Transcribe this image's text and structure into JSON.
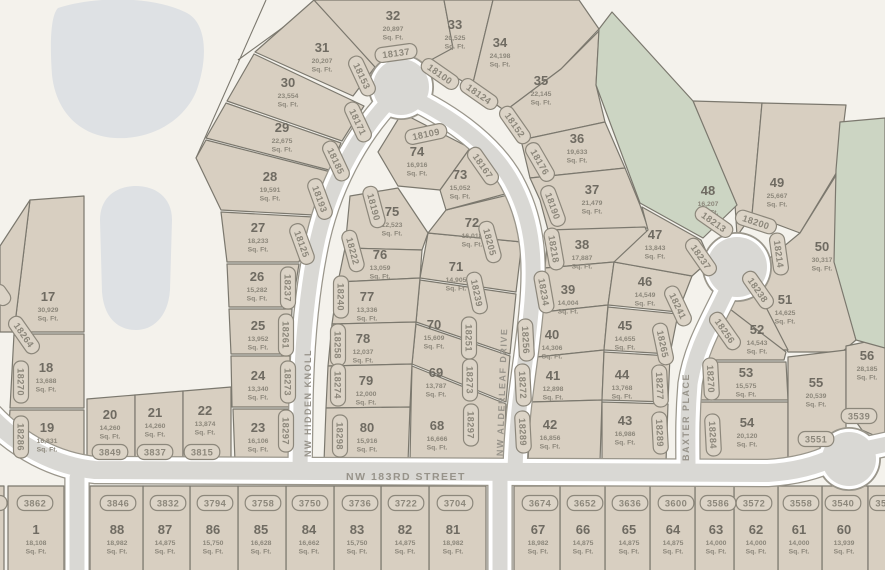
{
  "map": {
    "colors": {
      "background": "#f4f2ec",
      "lot_fill": "#d8cfc1",
      "green_fill": "#ccd5c3",
      "pond_fill": "#dee1e4",
      "street_fill": "#d9d8d4",
      "street_casing": "#ffffff",
      "street_halo": "#9a968b",
      "lot_stroke": "#7b786e",
      "number_color": "#6f6b62",
      "sqft_color": "#8c877b",
      "badge_color": "#8c877b",
      "badge_fill": "#dcd4c7",
      "street_label_color": "#97938a"
    },
    "sqft_suffix": "Sq. Ft.",
    "street_labels": [
      {
        "text": "NW HIDDEN KNOLL",
        "x": 311,
        "y": 403,
        "rot": -90,
        "size": 9
      },
      {
        "text": "NW ALDERLEAF DRIVE",
        "x": 505,
        "y": 392,
        "rot": -88,
        "size": 9
      },
      {
        "text": "BAXTER PLACE",
        "x": 689,
        "y": 417,
        "rot": -90,
        "size": 9
      },
      {
        "text": "NW 183RD STREET",
        "x": 406,
        "y": 480,
        "rot": 0,
        "size": 10.5
      }
    ],
    "street_paths": [
      {
        "name": "nw-hidden-knoll",
        "d": "M 400,90 C 362,126 332,178 318,238 C 306,292 302,350 301,400 L 300,470",
        "w": 15
      },
      {
        "name": "nw-alderleaf-drive",
        "d": "M 404,94 C 452,116 496,148 515,188 C 533,224 536,262 531,312 C 526,366 517,402 515,470",
        "w": 15
      },
      {
        "name": "baxter-place",
        "d": "M 737,266 C 722,308 697,338 690,384 C 687,420 688,444 688,470",
        "w": 15
      },
      {
        "name": "nw-183rd-street",
        "d": "M -10,416 C 18,446 55,466 95,470 L 768,473 C 800,471 820,464 834,457",
        "w": 18
      },
      {
        "name": "south-stub-west",
        "d": "M 77,478 L 77,578",
        "w": 15
      },
      {
        "name": "south-stub-east",
        "d": "M 500,478 L 500,578",
        "w": 15
      },
      {
        "name": "east-exit",
        "d": "M 860,450 L 892,443",
        "w": 15
      }
    ],
    "street_circles": [
      {
        "name": "teardrop-turnaround",
        "cx": 401,
        "cy": 87,
        "r": 28
      },
      {
        "name": "baxter-bulb",
        "cx": 737,
        "cy": 267,
        "r": 30
      },
      {
        "name": "knuckle-east",
        "cx": 849,
        "cy": 459,
        "r": 27
      }
    ],
    "ponds": [
      {
        "d": "M 58,8 C 95,-4 152,-4 185,12 C 208,22 208,60 196,92 C 183,122 150,140 115,138 C 80,136 56,112 52,75 C 50,48 50,16 58,8 Z"
      },
      {
        "d": "M 100,220 C 100,196 118,186 136,186 C 154,186 172,196 172,220 L 170,290 C 168,318 152,330 136,330 C 118,330 104,318 102,292 Z"
      }
    ],
    "extra_lines": [
      {
        "x1": 196,
        "y1": 158,
        "x2": 266,
        "y2": 0
      },
      {
        "x1": 318,
        "y1": 2,
        "x2": 238,
        "y2": 60
      }
    ],
    "greens": [
      {
        "poly": "612,12 693,101 737,205 703,238 640,203 596,85 599,29"
      },
      {
        "poly": "840,122 885,118 885,348 856,340 834,262 836,170"
      }
    ],
    "lots": [
      {
        "n": "1",
        "sq": "18,108",
        "addr": "3862",
        "poly": "8,486 64,486 64,575 8,575",
        "nx": 36,
        "ny": 530,
        "ax": 35,
        "ay": 503,
        "ar": 0
      },
      {
        "n": "",
        "sq": "",
        "addr": "",
        "poly": "-6,486 4,486 4,575 -6,575",
        "nx": 0,
        "ny": 0,
        "ax": -4,
        "ay": 503,
        "ar": 0
      },
      {
        "n": "17",
        "sq": "30,929",
        "addr": "18264",
        "poly": "30,200 84,196 84,332 14,332",
        "nx": 48,
        "ny": 297,
        "ax": 24,
        "ay": 335,
        "ar": 55
      },
      {
        "n": "",
        "sq": "",
        "addr": "",
        "poly": "30,200 14,332 0,332 0,246",
        "nx": 0,
        "ny": 0,
        "ax": 1,
        "ay": 295,
        "ar": 55
      },
      {
        "n": "18",
        "sq": "13,688",
        "addr": "18270",
        "poly": "14,334 84,334 84,408 10,408",
        "nx": 46,
        "ny": 368,
        "ax": 21,
        "ay": 382,
        "ar": 90
      },
      {
        "n": "19",
        "sq": "16,831",
        "addr": "18286",
        "poly": "10,410 84,410 84,462 36,462 8,440",
        "nx": 47,
        "ny": 428,
        "ax": 21,
        "ay": 437,
        "ar": 90
      },
      {
        "n": "20",
        "sq": "14,260",
        "addr": "3849",
        "poly": "87,399 135,395 135,462 87,462",
        "nx": 110,
        "ny": 415,
        "ax": 110,
        "ay": 452,
        "ar": 0
      },
      {
        "n": "21",
        "sq": "14,260",
        "addr": "3837",
        "poly": "135,395 183,391 183,462 135,462",
        "nx": 155,
        "ny": 413,
        "ax": 155,
        "ay": 452,
        "ar": 0
      },
      {
        "n": "22",
        "sq": "13,874",
        "addr": "3815",
        "poly": "183,391 231,387 231,462 183,462",
        "nx": 205,
        "ny": 411,
        "ax": 202,
        "ay": 452,
        "ar": 0
      },
      {
        "n": "23",
        "sq": "16,106",
        "addr": "18297",
        "poly": "233,409 289,409 289,462 235,462",
        "nx": 258,
        "ny": 428,
        "ax": 286,
        "ay": 431,
        "ar": 90
      },
      {
        "n": "24",
        "sq": "13,340",
        "addr": "18273",
        "poly": "231,356 290,356 289,407 232,407",
        "nx": 258,
        "ny": 376,
        "ax": 288,
        "ay": 382,
        "ar": 90
      },
      {
        "n": "25",
        "sq": "13,952",
        "addr": "18261",
        "poly": "229,309 292,309 290,354 231,354",
        "nx": 258,
        "ny": 326,
        "ax": 286,
        "ay": 335,
        "ar": 90
      },
      {
        "n": "26",
        "sq": "15,282",
        "addr": "18237",
        "poly": "227,264 299,264 292,307 229,307",
        "nx": 257,
        "ny": 277,
        "ax": 288,
        "ay": 288,
        "ar": 90
      },
      {
        "n": "27",
        "sq": "18,233",
        "addr": "18125",
        "poly": "221,212 313,217 299,262 227,262",
        "nx": 258,
        "ny": 228,
        "ax": 302,
        "ay": 244,
        "ar": 70
      },
      {
        "n": "28",
        "sq": "19,591",
        "addr": "18193",
        "poly": "196,158 206,140 331,172 313,215 221,210",
        "nx": 270,
        "ny": 177,
        "ax": 320,
        "ay": 199,
        "ar": 70
      },
      {
        "n": "29",
        "sq": "22,675",
        "addr": "18185",
        "poly": "206,138 226,103 341,143 329,170",
        "nx": 282,
        "ny": 128,
        "ax": 336,
        "ay": 161,
        "ar": 65
      },
      {
        "n": "30",
        "sq": "23,554",
        "addr": "18171",
        "poly": "227,101 254,54 364,106 342,141",
        "nx": 288,
        "ny": 83,
        "ax": 358,
        "ay": 122,
        "ar": 65
      },
      {
        "n": "31",
        "sq": "20,207",
        "addr": "18153",
        "poly": "255,52 314,0 340,28 375,67 353,96",
        "nx": 322,
        "ny": 48,
        "ax": 362,
        "ay": 76,
        "ar": 65
      },
      {
        "n": "32",
        "sq": "20,897",
        "addr": "18137",
        "poly": "314,0 444,0 453,48 421,70 375,67",
        "nx": 393,
        "ny": 16,
        "ax": 396,
        "ay": 53,
        "ar": -8
      },
      {
        "n": "33",
        "sq": "20,525",
        "addr": "18100",
        "poly": "444,0 493,0 472,87 429,61 453,48",
        "nx": 455,
        "ny": 25,
        "ax": 440,
        "ay": 74,
        "ar": 35
      },
      {
        "n": "34",
        "sq": "24,198",
        "addr": "18124",
        "poly": "493,0 579,0 599,29 561,69 505,111 472,87",
        "nx": 500,
        "ny": 43,
        "ax": 479,
        "ay": 94,
        "ar": 35
      },
      {
        "n": "35",
        "sq": "22,145",
        "addr": "18152",
        "poly": "505,111 561,69 599,31 596,85 605,122 521,140",
        "nx": 541,
        "ny": 81,
        "ax": 515,
        "ay": 125,
        "ar": 55
      },
      {
        "n": "36",
        "sq": "19,633",
        "addr": "18176",
        "poly": "521,140 605,122 625,168 530,178",
        "nx": 577,
        "ny": 139,
        "ax": 540,
        "ay": 162,
        "ar": 60
      },
      {
        "n": "37",
        "sq": "21,479",
        "addr": "18190",
        "poly": "530,178 625,168 640,205 648,228 548,230 540,200",
        "nx": 592,
        "ny": 190,
        "ax": 553,
        "ay": 206,
        "ar": 70
      },
      {
        "n": "38",
        "sq": "17,887",
        "addr": "18218",
        "poly": "548,230 645,227 655,252 614,262 545,268",
        "nx": 582,
        "ny": 245,
        "ax": 554,
        "ay": 249,
        "ar": 80
      },
      {
        "n": "39",
        "sq": "14,004",
        "addr": "18234",
        "poly": "545,268 614,262 608,305 543,312",
        "nx": 568,
        "ny": 290,
        "ax": 544,
        "ay": 292,
        "ar": 80
      },
      {
        "n": "40",
        "sq": "14,306",
        "addr": "18256",
        "poly": "543,312 608,305 604,350 537,357",
        "nx": 552,
        "ny": 335,
        "ax": 526,
        "ay": 340,
        "ar": 87
      },
      {
        "n": "41",
        "sq": "12,898",
        "addr": "18272",
        "poly": "537,357 604,350 602,400 531,402",
        "nx": 553,
        "ny": 376,
        "ax": 523,
        "ay": 385,
        "ar": 87
      },
      {
        "n": "42",
        "sq": "16,856",
        "addr": "18289",
        "poly": "531,402 602,400 600,462 528,462",
        "nx": 550,
        "ny": 425,
        "ax": 523,
        "ay": 432,
        "ar": 87
      },
      {
        "n": "43",
        "sq": "16,986",
        "addr": "18289",
        "poly": "602,402 668,404 666,462 602,462",
        "nx": 625,
        "ny": 421,
        "ax": 660,
        "ay": 433,
        "ar": 87
      },
      {
        "n": "44",
        "sq": "13,768",
        "addr": "18277",
        "poly": "604,352 670,356 668,402 602,400",
        "nx": 622,
        "ny": 375,
        "ax": 660,
        "ay": 386,
        "ar": 87
      },
      {
        "n": "45",
        "sq": "14,655",
        "addr": "18265",
        "poly": "608,307 678,314 670,354 604,350",
        "nx": 625,
        "ny": 326,
        "ax": 663,
        "ay": 344,
        "ar": 78
      },
      {
        "n": "46",
        "sq": "14,549",
        "addr": "18241",
        "poly": "614,262 692,276 678,312 608,305",
        "nx": 645,
        "ny": 282,
        "ax": 678,
        "ay": 306,
        "ar": 65
      },
      {
        "n": "47",
        "sq": "13,843",
        "addr": "18237",
        "poly": "642,207 701,240 710,260 692,276 614,262 648,230",
        "nx": 655,
        "ny": 235,
        "ax": 701,
        "ay": 257,
        "ar": 55
      },
      {
        "n": "48",
        "sq": "16,207",
        "addr": "18213",
        "poly": "693,101 762,103 752,215 737,236 735,204",
        "nx": 708,
        "ny": 191,
        "ax": 714,
        "ay": 222,
        "ar": 35
      },
      {
        "n": "49",
        "sq": "25,667",
        "addr": "18200",
        "poly": "762,103 846,105 838,170 800,233 752,215",
        "nx": 777,
        "ny": 183,
        "ax": 756,
        "ay": 222,
        "ar": 18
      },
      {
        "n": "50",
        "sq": "30,317",
        "addr": "18214",
        "poly": "800,233 838,172 836,262 856,340 842,352 788,352 748,276",
        "nx": 822,
        "ny": 247,
        "ax": 779,
        "ay": 254,
        "ar": 82
      },
      {
        "n": "51",
        "sq": "14,625",
        "addr": "18238",
        "poly": "752,280 788,350 736,350 724,305",
        "nx": 785,
        "ny": 300,
        "ax": 758,
        "ay": 290,
        "ar": 55
      },
      {
        "n": "52",
        "sq": "14,543",
        "addr": "18256",
        "poly": "704,332 726,306 786,352 784,360 704,360",
        "nx": 757,
        "ny": 330,
        "ax": 725,
        "ay": 331,
        "ar": 55
      },
      {
        "n": "53",
        "sq": "15,575",
        "addr": "18270",
        "poly": "702,362 786,362 788,400 700,400",
        "nx": 746,
        "ny": 373,
        "ax": 711,
        "ay": 379,
        "ar": 87
      },
      {
        "n": "54",
        "sq": "20,120",
        "addr": "18284",
        "poly": "700,402 788,402 788,462 698,462",
        "nx": 747,
        "ny": 423,
        "ax": 713,
        "ay": 435,
        "ar": 87
      },
      {
        "n": "55",
        "sq": "20,539",
        "addr": "3551",
        "poly": "788,357 846,350 846,462 788,462",
        "nx": 816,
        "ny": 383,
        "ax": 816,
        "ay": 439,
        "ar": 0
      },
      {
        "n": "56",
        "sq": "28,185",
        "addr": "3539",
        "poly": "846,346 885,338 885,440 862,430 846,408",
        "nx": 867,
        "ny": 356,
        "ax": 859,
        "ay": 416,
        "ar": 0
      },
      {
        "n": "60",
        "sq": "13,939",
        "addr": "3540",
        "poly": "822,486 868,486 868,575 822,575",
        "nx": 844,
        "ny": 530,
        "ax": 843,
        "ay": 503,
        "ar": 0
      },
      {
        "n": "",
        "sq": "",
        "addr": "35",
        "poly": "868,486 890,486 890,575 868,575",
        "nx": 0,
        "ny": 0,
        "ax": 881,
        "ay": 503,
        "ar": 0
      },
      {
        "n": "61",
        "sq": "14,000",
        "addr": "3558",
        "poly": "778,486 822,486 822,575 778,575",
        "nx": 799,
        "ny": 530,
        "ax": 801,
        "ay": 503,
        "ar": 0
      },
      {
        "n": "62",
        "sq": "14,000",
        "addr": "3572",
        "poly": "734,486 778,486 778,575 734,575",
        "nx": 756,
        "ny": 530,
        "ax": 754,
        "ay": 503,
        "ar": 0
      },
      {
        "n": "63",
        "sq": "14,000",
        "addr": "3586",
        "poly": "695,486 734,486 734,575 695,575",
        "nx": 716,
        "ny": 530,
        "ax": 718,
        "ay": 503,
        "ar": 0
      },
      {
        "n": "64",
        "sq": "14,875",
        "addr": "3600",
        "poly": "650,486 695,486 695,575 650,575",
        "nx": 673,
        "ny": 530,
        "ax": 676,
        "ay": 503,
        "ar": 0
      },
      {
        "n": "65",
        "sq": "14,875",
        "addr": "3636",
        "poly": "605,486 650,486 650,575 605,575",
        "nx": 629,
        "ny": 530,
        "ax": 630,
        "ay": 503,
        "ar": 0
      },
      {
        "n": "66",
        "sq": "14,875",
        "addr": "3652",
        "poly": "560,486 605,486 605,575 560,575",
        "nx": 583,
        "ny": 530,
        "ax": 585,
        "ay": 503,
        "ar": 0
      },
      {
        "n": "67",
        "sq": "18,982",
        "addr": "3674",
        "poly": "514,486 560,486 560,575 514,575",
        "nx": 538,
        "ny": 530,
        "ax": 540,
        "ay": 503,
        "ar": 0
      },
      {
        "n": "68",
        "sq": "16,666",
        "addr": "18297",
        "poly": "412,366 506,404 504,462 410,462 411,408",
        "nx": 437,
        "ny": 426,
        "ax": 471,
        "ay": 425,
        "ar": 90
      },
      {
        "n": "69",
        "sq": "13,787",
        "addr": "18273",
        "poly": "416,324 510,356 506,402 412,364",
        "nx": 436,
        "ny": 373,
        "ax": 470,
        "ay": 380,
        "ar": 90
      },
      {
        "n": "70",
        "sq": "15,609",
        "addr": "18251",
        "poly": "420,280 516,294 510,354 416,322",
        "nx": 434,
        "ny": 325,
        "ax": 469,
        "ay": 338,
        "ar": 90
      },
      {
        "n": "71",
        "sq": "14,905",
        "addr": "18239",
        "poly": "428,233 522,242 516,292 420,278",
        "nx": 456,
        "ny": 267,
        "ax": 477,
        "ay": 293,
        "ar": 78
      },
      {
        "n": "72",
        "sq": "16,018",
        "addr": "18205",
        "poly": "446,210 512,194 522,242 428,233",
        "nx": 472,
        "ny": 223,
        "ax": 490,
        "ay": 242,
        "ar": 75
      },
      {
        "n": "73",
        "sq": "15,052",
        "addr": "18167",
        "poly": "440,190 470,148 504,178 512,192 446,210",
        "nx": 460,
        "ny": 175,
        "ax": 483,
        "ay": 166,
        "ar": 55
      },
      {
        "n": "74",
        "sq": "16,916",
        "addr": "18109",
        "poly": "378,152 402,113 470,148 440,190 398,186",
        "nx": 417,
        "ny": 152,
        "ax": 426,
        "ay": 134,
        "ar": -12
      },
      {
        "n": "75",
        "sq": "12,523",
        "addr": "18190",
        "poly": "350,196 398,188 428,233 422,250 345,248",
        "nx": 392,
        "ny": 212,
        "ax": 374,
        "ay": 207,
        "ar": 75
      },
      {
        "n": "76",
        "sq": "13,059",
        "addr": "18222",
        "poly": "345,248 422,250 420,278 338,282",
        "nx": 380,
        "ny": 255,
        "ax": 353,
        "ay": 251,
        "ar": 75
      },
      {
        "n": "77",
        "sq": "13,336",
        "addr": "18240",
        "poly": "338,282 420,278 416,322 332,324",
        "nx": 367,
        "ny": 297,
        "ax": 341,
        "ay": 297,
        "ar": 90
      },
      {
        "n": "78",
        "sq": "12,037",
        "addr": "18258",
        "poly": "332,324 416,322 412,364 328,366",
        "nx": 363,
        "ny": 339,
        "ax": 338,
        "ay": 345,
        "ar": 90
      },
      {
        "n": "79",
        "sq": "12,000",
        "addr": "18274",
        "poly": "328,366 412,364 410,407 326,408",
        "nx": 366,
        "ny": 381,
        "ax": 338,
        "ay": 385,
        "ar": 90
      },
      {
        "n": "80",
        "sq": "15,916",
        "addr": "18298",
        "poly": "326,408 410,407 408,462 324,462",
        "nx": 367,
        "ny": 428,
        "ax": 340,
        "ay": 436,
        "ar": 90
      },
      {
        "n": "81",
        "sq": "18,982",
        "addr": "3704",
        "poly": "429,486 486,486 486,575 429,575",
        "nx": 453,
        "ny": 530,
        "ax": 455,
        "ay": 503,
        "ar": 0
      },
      {
        "n": "82",
        "sq": "14,875",
        "addr": "3722",
        "poly": "381,486 429,486 429,575 381,575",
        "nx": 405,
        "ny": 530,
        "ax": 406,
        "ay": 503,
        "ar": 0
      },
      {
        "n": "83",
        "sq": "15,750",
        "addr": "3736",
        "poly": "334,486 381,486 381,575 334,575",
        "nx": 357,
        "ny": 530,
        "ax": 360,
        "ay": 503,
        "ar": 0
      },
      {
        "n": "84",
        "sq": "16,662",
        "addr": "3750",
        "poly": "286,486 334,486 334,575 286,575",
        "nx": 309,
        "ny": 530,
        "ax": 310,
        "ay": 503,
        "ar": 0
      },
      {
        "n": "85",
        "sq": "16,628",
        "addr": "3758",
        "poly": "238,486 286,486 286,575 238,575",
        "nx": 261,
        "ny": 530,
        "ax": 263,
        "ay": 503,
        "ar": 0
      },
      {
        "n": "86",
        "sq": "15,750",
        "addr": "3794",
        "poly": "190,486 238,486 238,575 190,575",
        "nx": 213,
        "ny": 530,
        "ax": 215,
        "ay": 503,
        "ar": 0
      },
      {
        "n": "87",
        "sq": "14,875",
        "addr": "3832",
        "poly": "143,486 190,486 190,575 143,575",
        "nx": 165,
        "ny": 530,
        "ax": 168,
        "ay": 503,
        "ar": 0
      },
      {
        "n": "88",
        "sq": "18,982",
        "addr": "3846",
        "poly": "90,486 143,486 143,575 90,575",
        "nx": 117,
        "ny": 530,
        "ax": 118,
        "ay": 503,
        "ar": 0
      }
    ]
  }
}
